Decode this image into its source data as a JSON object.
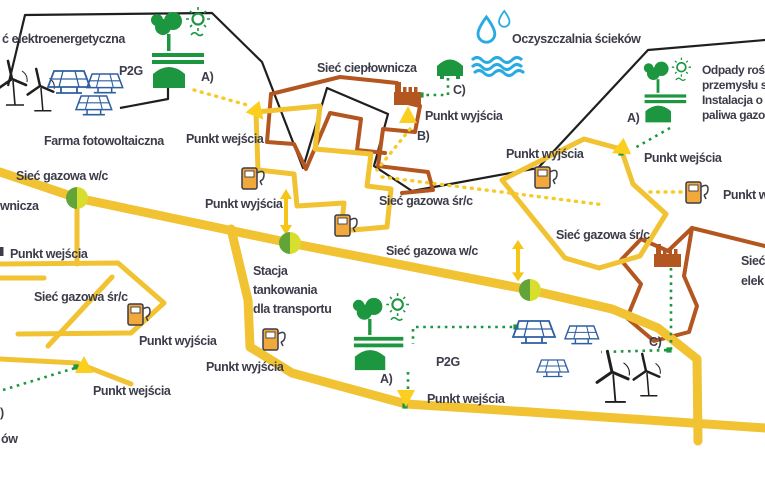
{
  "diagram": {
    "title_hint": "Schemat sieci gazowej z punktami wejścia i wyjścia",
    "colors": {
      "gas_network": "#F1C232",
      "gas_marker": "#FCCE1E",
      "heat_network": "#B3561F",
      "electric_network": "#1F1F1F",
      "green_gas": "#1D9640",
      "water_blue": "#29ABE2",
      "solar_blue": "#2E5FA3",
      "node_green": "#63A438",
      "node_yellow": "#D8DE2D",
      "pump_fill": "#F2A93B",
      "text": "#3C3C4A"
    },
    "icons": {
      "wind-turbine-icon": "three-blade turbine outline",
      "solar-panel-icon": "blue grid panel on legs",
      "biogas-plant-icon": "tree + sun + field bars + green dome tank",
      "sewage-plant-icon": "green dome + water drops + waves",
      "factory-icon": "brown castellated building with chimney",
      "gas-pump-icon": "yellow fuel dispenser with hose",
      "network-node-icon": "green/yellow split circle",
      "entry-exit-triangle-icon": "yellow triangle marker",
      "double-arrow-icon": "yellow two-headed arrow",
      "green-terminal-icon": "small green square"
    },
    "labels": {
      "net_electric": "ć elektroenergetyczna",
      "p2g_top": "P2G",
      "pv_farm": "Farma fotowoltaiczna",
      "marker_a_top": "A)",
      "entry_top_left": "Punkt wejścia",
      "heat_network": "Sieć ciepłownicza",
      "sewage_plant": "Oczyszczalnia ścieków",
      "marker_c_top": "C)",
      "exit_top_center": "Punkt wyjścia",
      "marker_b_top": "B)",
      "waste_line1": "Odpady roś",
      "waste_line2": "przemysłu s",
      "waste_line3": "Instalacja o",
      "waste_line4": "paliwa gazo",
      "marker_a_right": "A)",
      "entry_right": "Punkt wejścia",
      "exit_right_upper": "Punkt wyjścia",
      "exit_right_edge": "Punkt wyj",
      "src_network_right": "Sieć gazowa śr/c",
      "elec_right_line1": "Sieć",
      "elec_right_line2": "elek",
      "wc_network_left": "Sieć gazowa w/c",
      "heat_left_fragment": "wnicza",
      "entry_left": "Punkt wejścia",
      "src_network_left": "Sieć gazowa śr/c",
      "exit_bottom_left1": "Punkt wyjścia",
      "exit_bottom_left2": "Punkt wyjścia",
      "entry_bottom_left": "Punkt wejścia",
      "fragment_paren": ")",
      "fragment_ow": "ów",
      "exit_center": "Punkt wyjścia",
      "src_network_center": "Sieć gazowa śr/c",
      "wc_network_center": "Sieć gazowa w/c",
      "station_line1": "Stacja",
      "station_line2": "tankowania",
      "station_line3": "dla transportu",
      "p2g_bottom": "P2G",
      "marker_a_bottom": "A)",
      "entry_bottom": "Punkt wejścia",
      "marker_c_right": "C)"
    }
  }
}
